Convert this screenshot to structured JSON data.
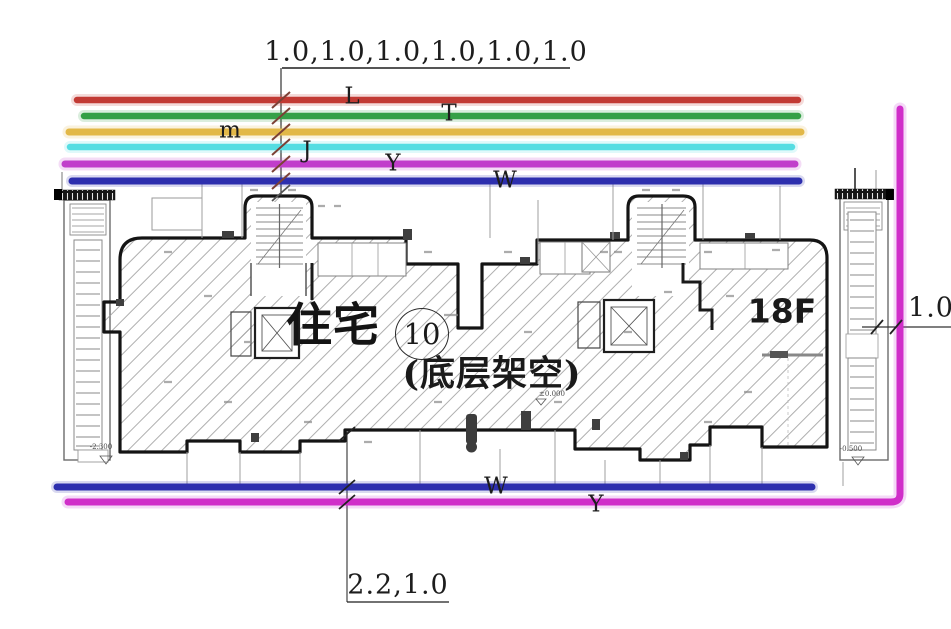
{
  "annotations": {
    "top_dimension": "1.0,1.0,1.0,1.0,1.0,1.0",
    "bottom_dimension": "2.2,1.0",
    "right_dimension": "1.0"
  },
  "utility_lines": {
    "top": [
      {
        "label": "L",
        "color": "#c23a34"
      },
      {
        "label": "T",
        "color": "#35a047"
      },
      {
        "label": "m",
        "color": "#e2b848"
      },
      {
        "label": "J",
        "color": "#55dde2"
      },
      {
        "label": "Y",
        "color": "#c13ecb"
      },
      {
        "label": "W",
        "color": "#2d2fae"
      }
    ],
    "bottom": [
      {
        "label": "W",
        "color": "#2d2fae"
      },
      {
        "label": "Y",
        "color": "#d02ec9"
      }
    ],
    "right_vertical_color": "#c42ed2"
  },
  "building": {
    "name": "住宅",
    "unit_number": "10",
    "ground_floor_note": "(底层架空)",
    "floor_count": "18F",
    "elevations": {
      "left": "-2.300",
      "center": "±0.000",
      "right": "-0.500"
    }
  }
}
